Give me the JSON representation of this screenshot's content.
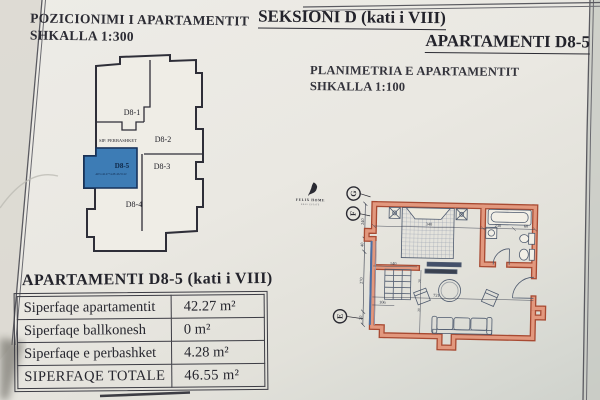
{
  "header": {
    "position_title": "POZICIONIMI I APARTAMENTIT",
    "position_scale": "SHKALLA 1:300",
    "section_title": "SEKSIONI D (kati i VIII)",
    "apartment_title": "APARTAMENTI D8-5",
    "plan_title": "PLANIMETRIA E APARTAMENTIT",
    "plan_scale": "SHKALLA 1:100"
  },
  "logo": {
    "name": "FELIX HOME",
    "subtitle": "REAL ESTATE"
  },
  "position_diagram": {
    "common_area_label": "SIP. PERBASHKET",
    "units": {
      "u1": "D8-1",
      "u2": "D8-2",
      "u3": "D8-3",
      "u4": "D8-4",
      "u5": "D8-5"
    },
    "highlighted_unit": "D8-5",
    "highlight_color": "#3d7cb5",
    "area_note": "AP.5=42.27+4.28=46.55 m²"
  },
  "floor_plan": {
    "grid_markers": {
      "g": "G",
      "f": "F",
      "e": "E"
    },
    "dims": {
      "left": {
        "d1": "240",
        "d2": "40",
        "d3": "270",
        "d4": "20"
      },
      "top": {
        "d1": "340",
        "d2": "230",
        "d3": "60"
      },
      "living": {
        "width": "721",
        "wardrobe": "140",
        "balcony": "106",
        "s1": "20",
        "s2": "20"
      }
    },
    "wall_color": "#e2987e",
    "wall_edge_color": "#a84a32",
    "window_color": "#4a6fa5"
  },
  "summary": {
    "title": "APARTAMENTI  D8-5 (kati i VIII)",
    "rows": [
      {
        "label": "Siperfaqe apartamentit",
        "value": "42.27 m²"
      },
      {
        "label": "Siperfaqe ballkonesh",
        "value": "0 m²"
      },
      {
        "label": "Siperfaqe e perbashket",
        "value": "4.28 m²"
      },
      {
        "label": "SIPERFAQE TOTALE",
        "value": "46.55 m²"
      }
    ]
  }
}
